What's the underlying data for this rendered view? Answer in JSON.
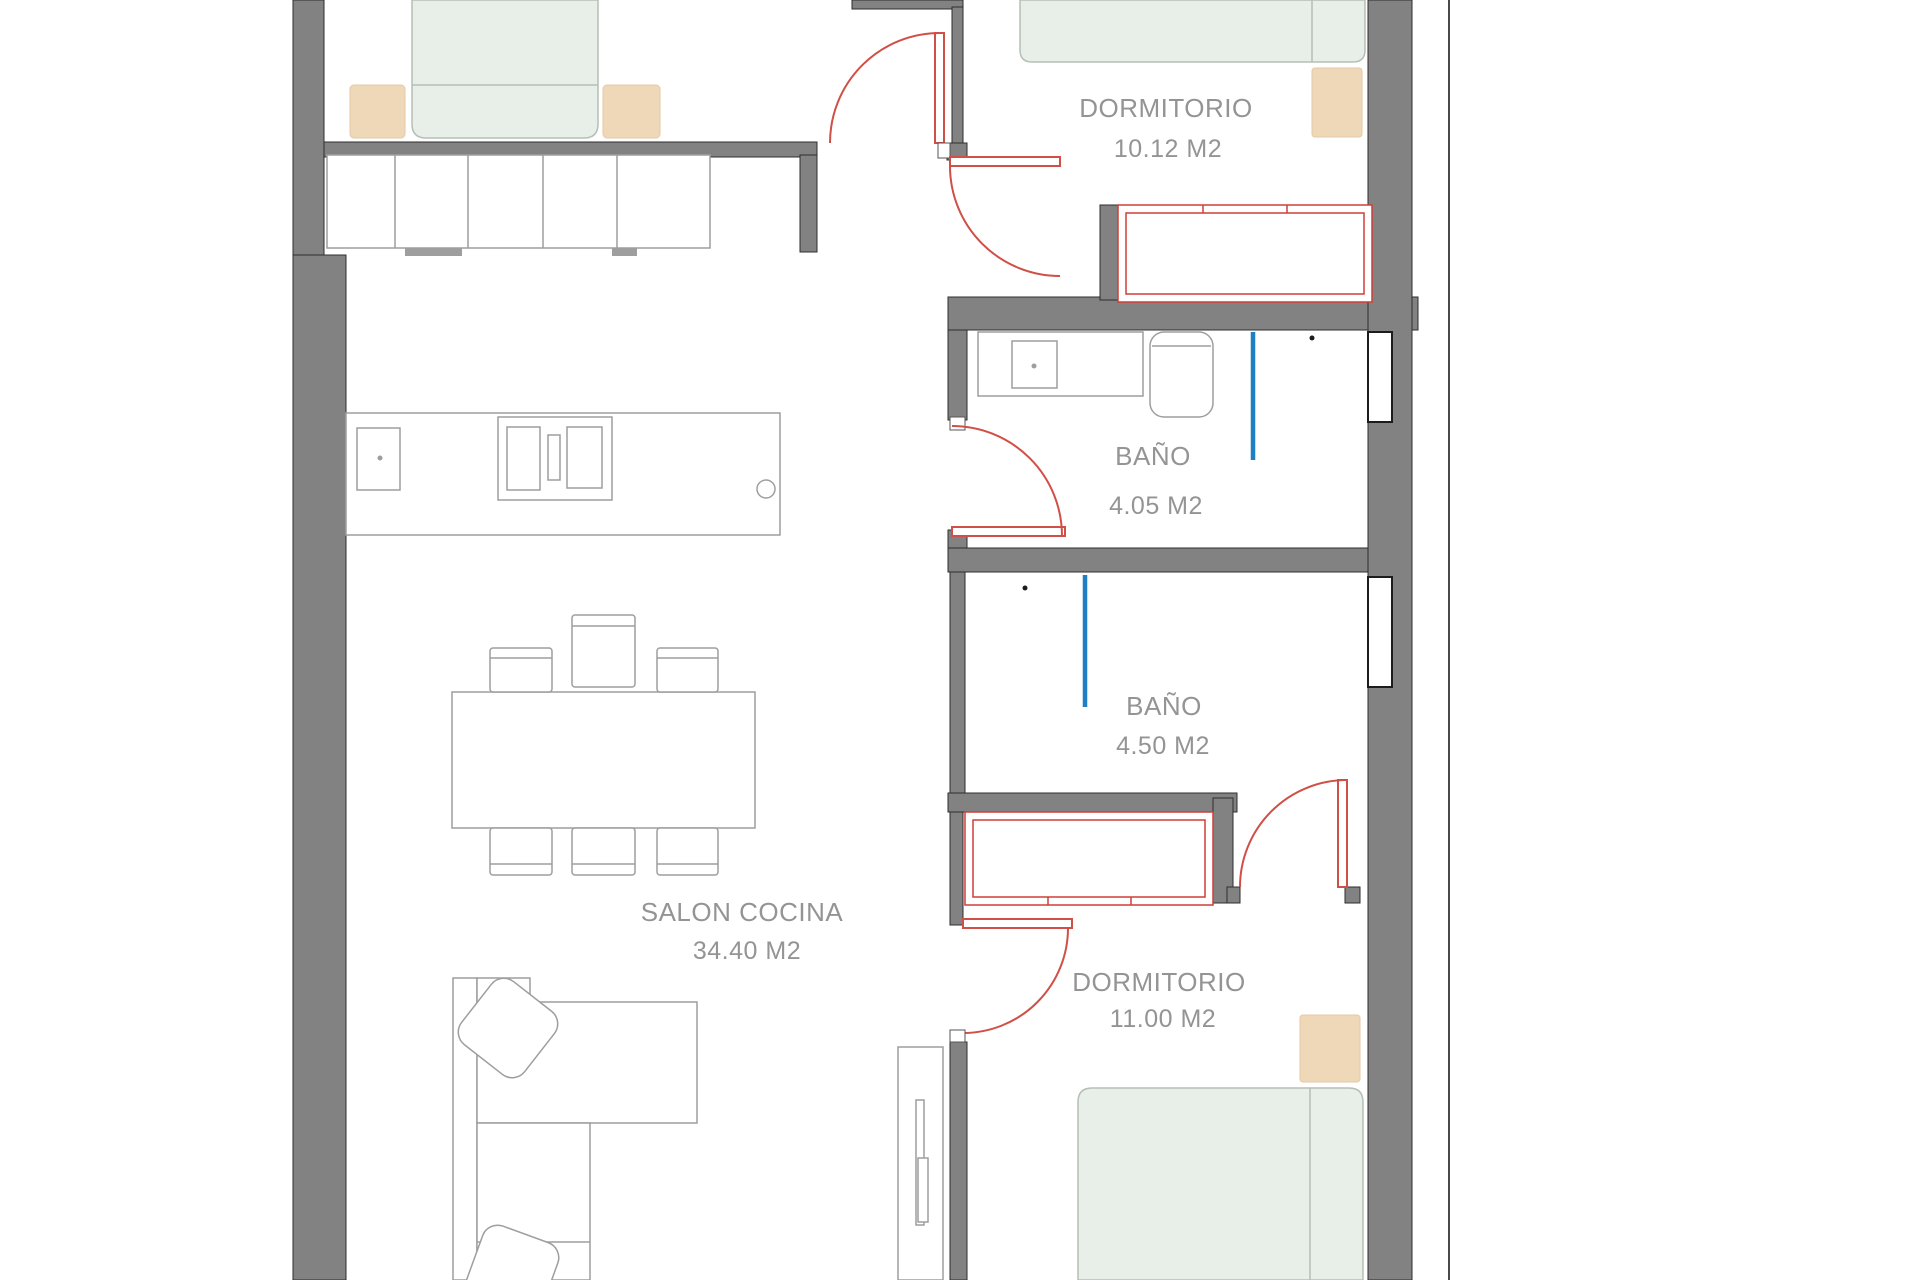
{
  "plan_title": "floor-plan",
  "rooms": [
    {
      "id": "dormitorio-1",
      "name": "DORMITORIO",
      "area": "10.12 M2"
    },
    {
      "id": "bano-1",
      "name": "BAÑO",
      "area": "4.05 M2"
    },
    {
      "id": "bano-2",
      "name": "BAÑO",
      "area": "4.50 M2"
    },
    {
      "id": "salon-cocina",
      "name": "SALON COCINA",
      "area": "34.40 M2"
    },
    {
      "id": "dormitorio-2",
      "name": "DORMITORIO",
      "area": "11.00 M2"
    }
  ],
  "colors": {
    "wall": "#828282",
    "wall_outline": "#2e2e2e",
    "door_red": "#d04f46",
    "wardrobe_red": "#cf3e36",
    "shower_screen_blue": "#1e7fc4",
    "bed_fill": "#e7efe8",
    "nightstand_fill": "#efd8b8",
    "furniture_outline": "#9e9e9e",
    "label_text": "#949494",
    "background": "#ffffff"
  }
}
